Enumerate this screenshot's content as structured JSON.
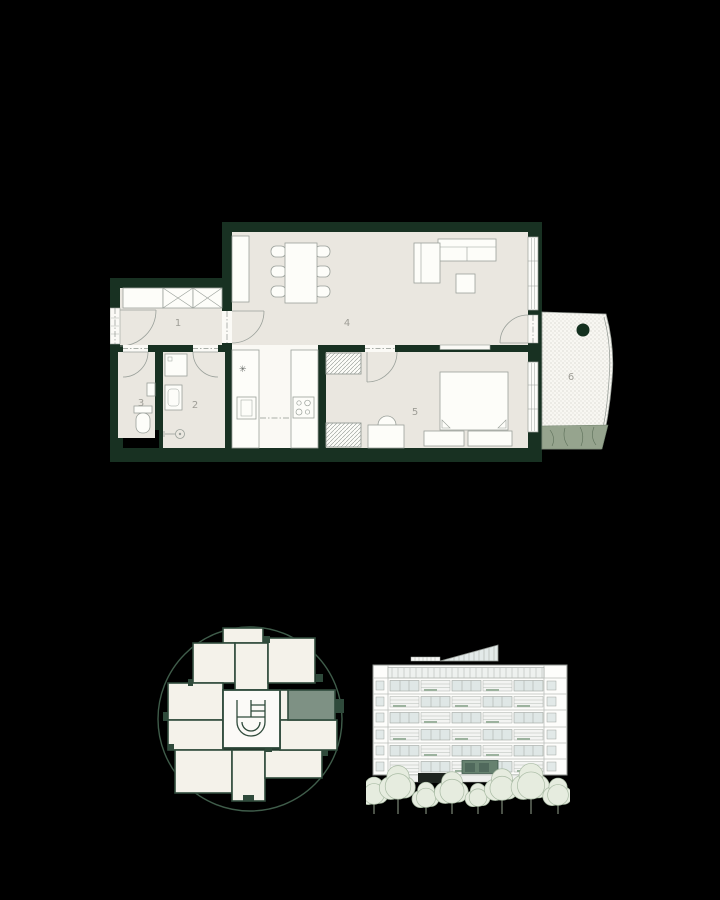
{
  "floor_plan": {
    "rooms": [
      {
        "label": "1"
      },
      {
        "label": "2"
      },
      {
        "label": "3"
      },
      {
        "label": "4"
      },
      {
        "label": "5"
      },
      {
        "label": "6"
      }
    ],
    "fridge_symbol": "✳"
  },
  "colors": {
    "background": "#000000",
    "wall_green": "#183122",
    "floor_beige": "#eae7e0",
    "floor_white": "#faf9f4",
    "furniture_line_grey": "#9aa09a",
    "label_grey": "#9e9d96",
    "accent_sage": "#7e9184",
    "accent_deep_green": "#2f4a3b",
    "balcony_planting_green": "#96a48e",
    "elevation_window_blue": "#dfe7e6",
    "elevation_highlight_green": "#66816f",
    "tree_fill_green": "#e6ecdf",
    "tree_outline_green": "#a9bba4"
  }
}
